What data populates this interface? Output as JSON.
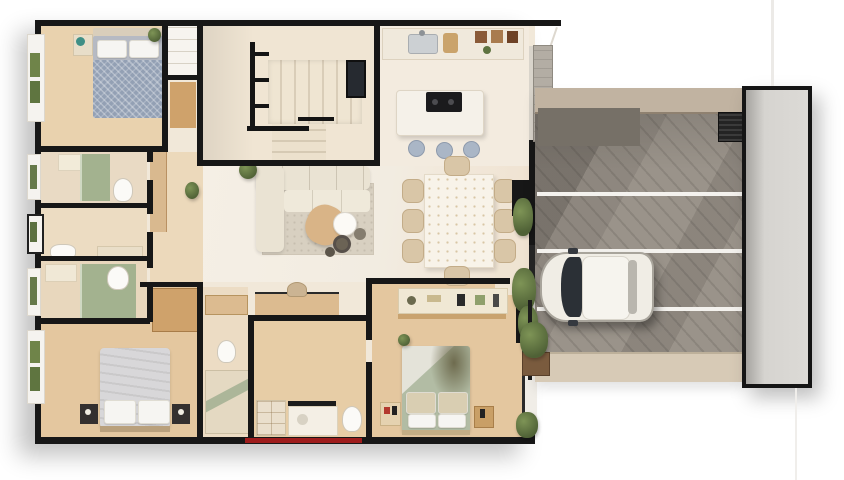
{
  "scene": {
    "title": "Top-down 3D architectural floor plan render of a single-storey house with side driveway",
    "style": "photorealistic dollhouse cutaway view, white background",
    "background": "#ffffff"
  },
  "rooms": [
    {
      "name": "bedroom-1"
    },
    {
      "name": "bathroom-1"
    },
    {
      "name": "wc-laundry"
    },
    {
      "name": "bathroom-2"
    },
    {
      "name": "master-bedroom"
    },
    {
      "name": "master-bathroom"
    },
    {
      "name": "hallway"
    },
    {
      "name": "staircase"
    },
    {
      "name": "kitchen"
    },
    {
      "name": "living-room"
    },
    {
      "name": "dining-area"
    },
    {
      "name": "study-nook"
    },
    {
      "name": "bathroom-3"
    },
    {
      "name": "bedroom-2"
    },
    {
      "name": "entry"
    },
    {
      "name": "driveway"
    },
    {
      "name": "gate-panel"
    }
  ],
  "furniture": {
    "bedroom_1": [
      "double bed with blue-grey patterned duvet",
      "two white pillows",
      "nightstand with plant",
      "corner plant",
      "left window to garden"
    ],
    "bathroom_1": [
      "green tiled shower",
      "toilet",
      "vanity"
    ],
    "wc_laundry": [
      "toilet",
      "counter",
      "window"
    ],
    "bathroom_2": [
      "green tiled shower",
      "toilet",
      "vanity",
      "window"
    ],
    "master_bedroom": [
      "large bed with light grey duvet",
      "two dark nightstands",
      "wood wardrobe",
      "garden window"
    ],
    "master_bathroom": [
      "wood counter",
      "toilet",
      "glass shower"
    ],
    "staircase": [
      "u-shaped stair with cream treads",
      "black metal railing",
      "window"
    ],
    "kitchen": [
      "wall counter with sink",
      "open shelf with dishes",
      "island with black cooktop",
      "three stools"
    ],
    "living_room": [
      "cream l-shaped sofa",
      "area rug",
      "tan ottoman table",
      "white round coffee table",
      "dark nesting tables",
      "floor plant"
    ],
    "dining_area": [
      "white rectangular table",
      "eight beige chairs"
    ],
    "study_nook": [
      "built-in wood desk",
      "chair"
    ],
    "bathroom_3": [
      "cubby shelf",
      "vanity with mirror",
      "toilet"
    ],
    "bedroom_2": [
      "bed with sage green duvet",
      "dresser console with decor",
      "two nightstands",
      "right windows"
    ],
    "driveway": [
      "concrete paving with diagonal joints",
      "three white stripes",
      "retaining wall",
      "air vent grille",
      "sidewalk",
      "planter with shrubs"
    ]
  },
  "vehicle": {
    "type": "car",
    "color_name": "white",
    "state": "parked facing left",
    "location": "driveway"
  },
  "colors": {
    "wall": "#171717",
    "house_base": "#f1e8d9",
    "wood_floor": "#e9d2ae",
    "wood_floor_warm": "#e4c79f",
    "cream_floor": "#f2ebe0",
    "corridor_floor": "#ecd9bb",
    "stair_floor": "#f0e5d3",
    "kitchen_floor": "#f3ebdf",
    "tile_green": "#a3b28f",
    "sofa": "#eae3d3",
    "rug": "#d8d0c1",
    "dining_table": "#f8f3e9",
    "chair": "#d9c6a7",
    "island": "#f5f1e9",
    "cooktop": "#1b1b1d",
    "stool": "#aab6c6",
    "bed1_duvet": "#93a0b4",
    "master_duvet": "#d8d7d9",
    "bed2_duvet": "#b2bca4",
    "pillow": "#f6f5f2",
    "nightstand_dark": "#34302f",
    "closet_wood": "#cfa26b",
    "desk_wood": "#dcbb90",
    "driveway": "#9a938a",
    "driveway_block": "#767067",
    "stripe": "#f4f2ee",
    "sidewalk": "#d7cab6",
    "retaining_wall": "#c1b3a1",
    "gate": "#d9d7d3",
    "car_body": "#f0ede5",
    "car_glass": "#2b3036",
    "plant": "#6d8148",
    "accent_red": "#9e1c1c"
  }
}
